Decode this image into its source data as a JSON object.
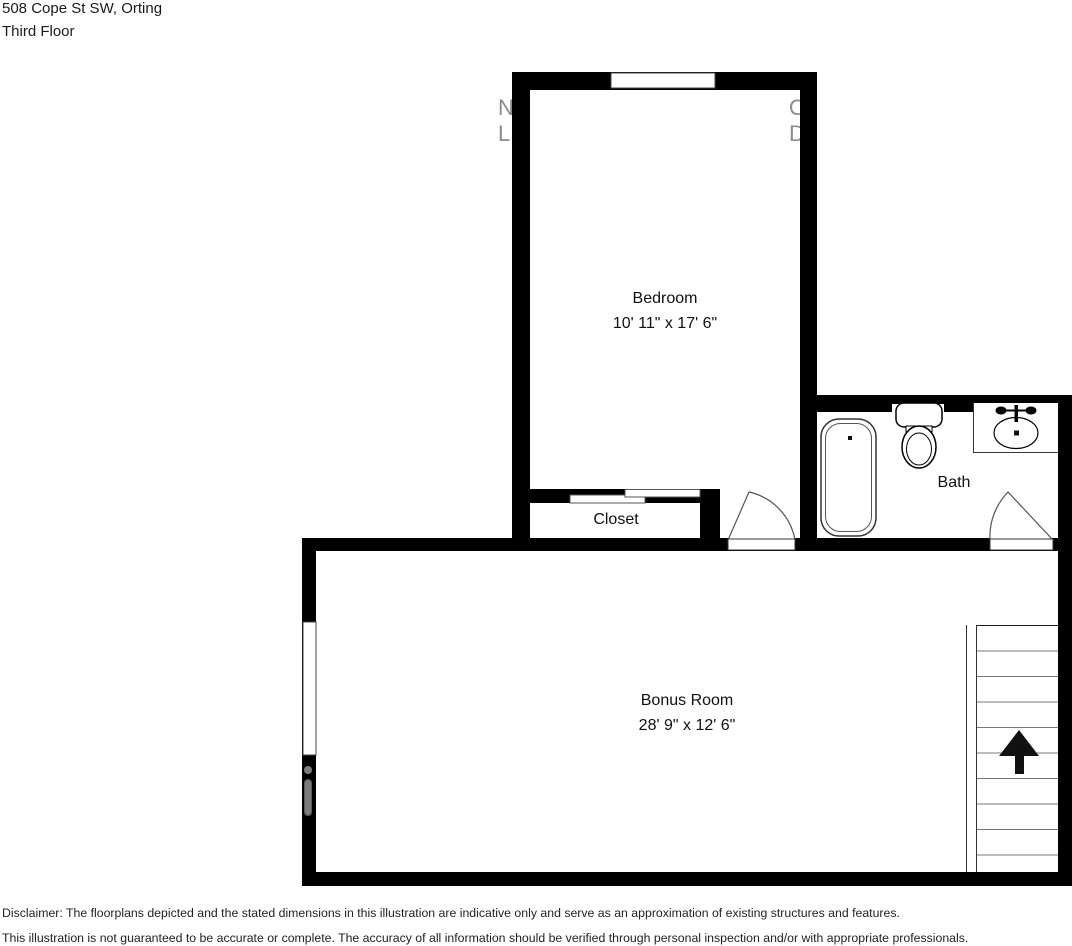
{
  "header": {
    "address": "508 Cope St SW, Orting",
    "floor": "Third Floor"
  },
  "rooms": {
    "bedroom": {
      "name": "Bedroom",
      "dimensions": "10' 11\" x 17' 6\""
    },
    "closet": {
      "name": "Closet"
    },
    "bath": {
      "name": "Bath"
    },
    "bonus": {
      "name": "Bonus Room",
      "dimensions": "28' 9\" x 12' 6\""
    }
  },
  "watermark": {
    "left_top": "N",
    "left_bottom": "L",
    "right_top": "O",
    "right_bottom": "DI"
  },
  "disclaimer": {
    "line1": "Disclaimer: The floorplans depicted and the stated dimensions in this illustration are indicative only and serve as an approximation of existing structures and features.",
    "line2": "This illustration is not guaranteed to be accurate or complete. The accuracy of all information should be verified through personal inspection and/or with appropriate professionals."
  },
  "colors": {
    "wall": "#000000",
    "watermark": "#8c8c8c",
    "fixture_outline": "#333333",
    "stair_tread": "#777777",
    "arrow": "#111111"
  }
}
